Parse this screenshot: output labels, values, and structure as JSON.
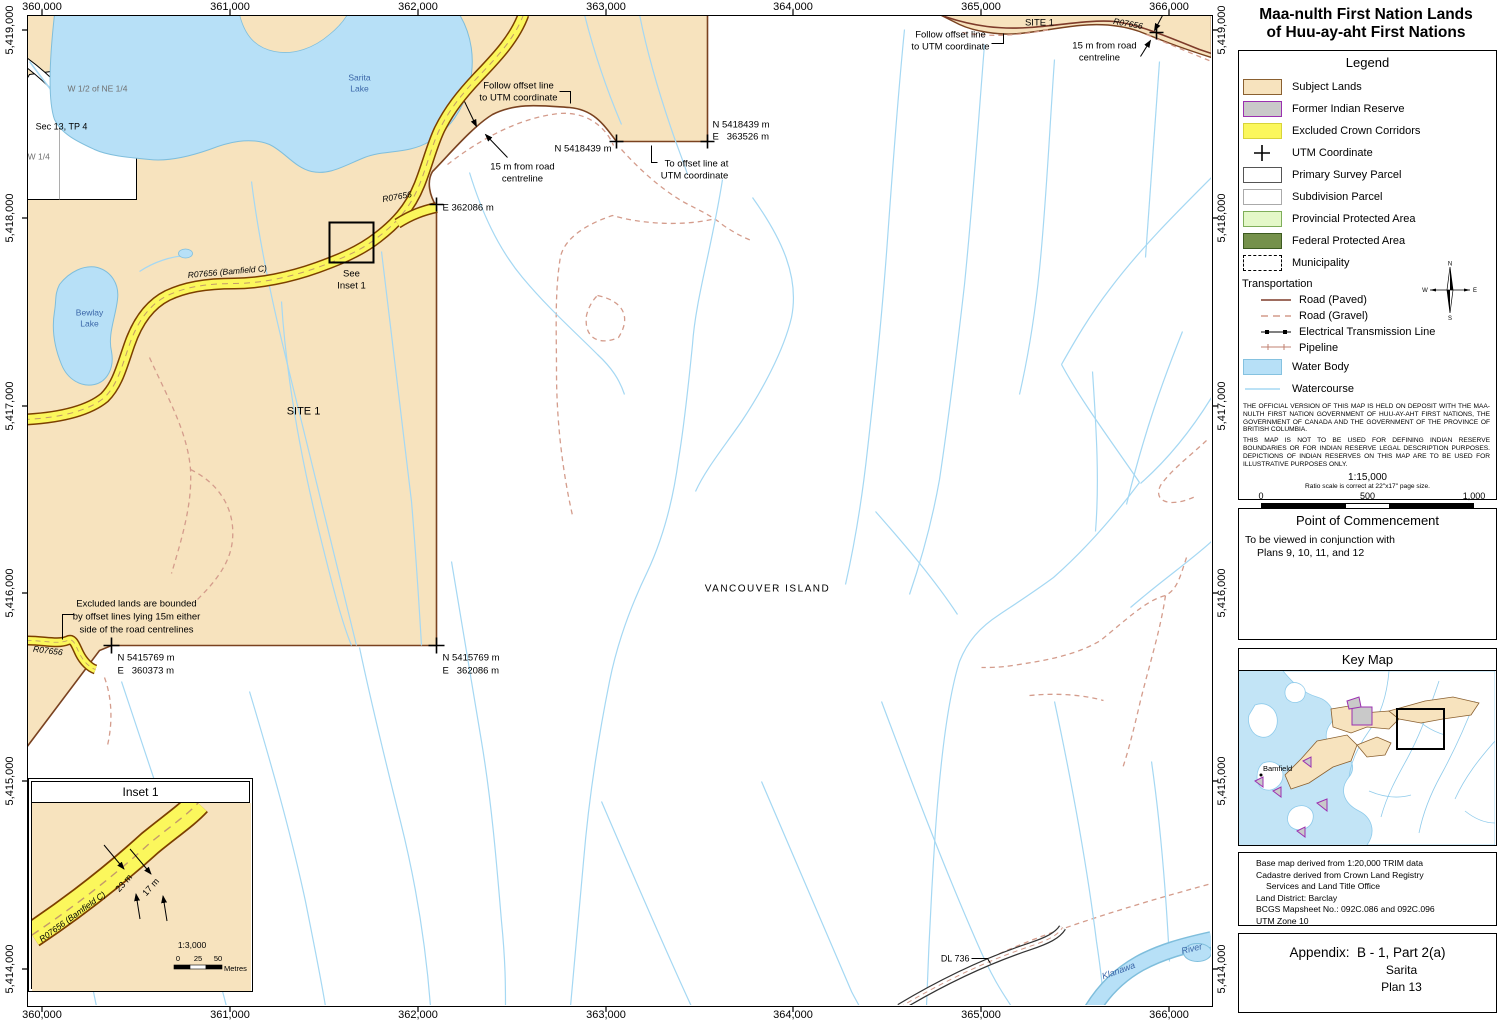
{
  "title": {
    "line1": "Maa-nulth First Nation Lands",
    "line2": "of Huu-ay-aht First Nations"
  },
  "axes": {
    "eastings": [
      "360,000",
      "361,000",
      "362,000",
      "363,000",
      "364,000",
      "365,000",
      "366,000"
    ],
    "northings": [
      "5,419,000",
      "5,418,000",
      "5,417,000",
      "5,416,000",
      "5,415,000",
      "5,414,000"
    ]
  },
  "legend": {
    "title": "Legend",
    "items": [
      {
        "label": "Subject Lands"
      },
      {
        "label": "Former Indian Reserve"
      },
      {
        "label": "Excluded Crown Corridors"
      },
      {
        "label": "UTM Coordinate"
      },
      {
        "label": "Primary Survey Parcel"
      },
      {
        "label": "Subdivision Parcel"
      },
      {
        "label": "Provincial Protected Area"
      },
      {
        "label": "Federal Protected Area"
      },
      {
        "label": "Municipality"
      }
    ],
    "transportation_label": "Transportation",
    "transport": [
      {
        "label": "Road (Paved)"
      },
      {
        "label": "Road (Gravel)"
      },
      {
        "label": "Electrical Transmission Line"
      },
      {
        "label": "Pipeline"
      }
    ],
    "water_body_label": "Water Body",
    "watercourse_label": "Watercourse",
    "compass": {
      "n": "N",
      "e": "E",
      "s": "S",
      "w": "W"
    },
    "disclaimer1": "THE OFFICIAL VERSION OF THIS MAP IS HELD ON DEPOSIT WITH THE MAA-NULTH FIRST NATION GOVERNMENT OF HUU-AY-AHT FIRST NATIONS, THE GOVERNMENT OF CANADA AND THE GOVERNMENT OF THE PROVINCE OF BRITISH COLUMBIA.",
    "disclaimer2": "THIS MAP IS NOT TO BE USED FOR DEFINING INDIAN RESERVE BOUNDARIES OR FOR INDIAN RESERVE LEGAL DESCRIPTION PURPOSES.  DEPICTIONS OF INDIAN RESERVES ON THIS MAP ARE TO BE USED FOR ILLUSTRATIVE PURPOSES ONLY.",
    "scale_ratio": "1:15,000",
    "scale_note": "Ratio scale is correct at 22\"x17\" page size.",
    "scale_ticks": [
      "0",
      "500",
      "1,000"
    ],
    "scale_unit": "Metres"
  },
  "poc": {
    "title": "Point of Commencement",
    "line1": "To be viewed in conjunction with",
    "line2": "Plans 9, 10, 11, and 12"
  },
  "keymap": {
    "title": "Key Map",
    "bamfield_label": "Bamfield"
  },
  "notes": {
    "line1": "Base map derived from 1:20,000 TRIM data",
    "line2": "Cadastre derived from Crown Land Registry",
    "line3": "Services and Land Title Office",
    "line4": "Land District: Barclay",
    "line5": "BCGS Mapsheet No.: 092C.086 and 092C.096",
    "line6": "UTM Zone 10"
  },
  "appendix": {
    "line1": "Appendix:  B - 1, Part 2(a)",
    "line2": "Sarita",
    "line3": "Plan 13"
  },
  "map_labels": {
    "sarita_lake_1": "Sarita",
    "sarita_lake_2": "Lake",
    "bewlay_lake_1": "Bewlay",
    "bewlay_lake_2": "Lake",
    "parcel_w_half": "W 1/2 of NE 1/4",
    "parcel_sec": "Sec 13, TP 4",
    "parcel_nw": "NW 1/4",
    "road_bamfield": "R07656 (Bamfield C)",
    "road_r07656_upper": "R07656",
    "road_r07656_topright": "R07656",
    "road_r07656_lowerleft": "R07656",
    "see_inset_1": "See",
    "see_inset_2": "Inset 1",
    "site1_main": "SITE 1",
    "site1_top": "SITE 1",
    "follow_offset_1": "Follow offset line",
    "follow_offset_2": "to UTM coordinate",
    "follow_offset_right_1": "Follow offset line",
    "follow_offset_right_2": "to UTM coordinate",
    "offset15_center_1": "15 m from road",
    "offset15_center_2": "centreline",
    "offset15_right_1": "15 m from road",
    "offset15_right_2": "centreline",
    "coord_n5418439": "N 5418439 m",
    "coord_ne_top_1": "N 5418439 m",
    "coord_ne_top_2": "E   363526 m",
    "to_offset_1": "To offset line at",
    "to_offset_2": "UTM coordinate",
    "coord_e362086": "E 362086 m",
    "excluded_1": "Excluded lands are bounded",
    "excluded_2": "by offset lines lying 15m either",
    "excluded_3": "side of the road centrelines",
    "coord_sw_1": "N 5415769 m",
    "coord_sw_2": "E   360373 m",
    "coord_se_1": "N 5415769 m",
    "coord_se_2": "E   362086 m",
    "vancouver_island": "VANCOUVER ISLAND",
    "dl736": "DL 736",
    "klanawa": "Klanawa",
    "river": "River"
  },
  "inset": {
    "title": "Inset 1",
    "road_label": "R07656 (Bamfield C)",
    "width_outer": "23 m",
    "width_inner": "17 m",
    "scale_ratio": "1:3,000",
    "ticks": [
      "0",
      "25",
      "50"
    ],
    "unit": "Metres"
  },
  "colors": {
    "subject_lands": "#F7E3BE",
    "excluded_corridor": "#FBF75C",
    "water": "#B7E0F7",
    "water_edge": "#7FBEDC",
    "reserve_fill": "#C9C9C9",
    "reserve_border": "#9B30B0",
    "provincial_protected": "#E4F8C8",
    "federal_protected": "#75914B",
    "paved_road": "#7E3B2A",
    "gravel_road": "#D49C8C",
    "site_boundary": "#7A4220",
    "watercourse": "#A5D8F3"
  }
}
